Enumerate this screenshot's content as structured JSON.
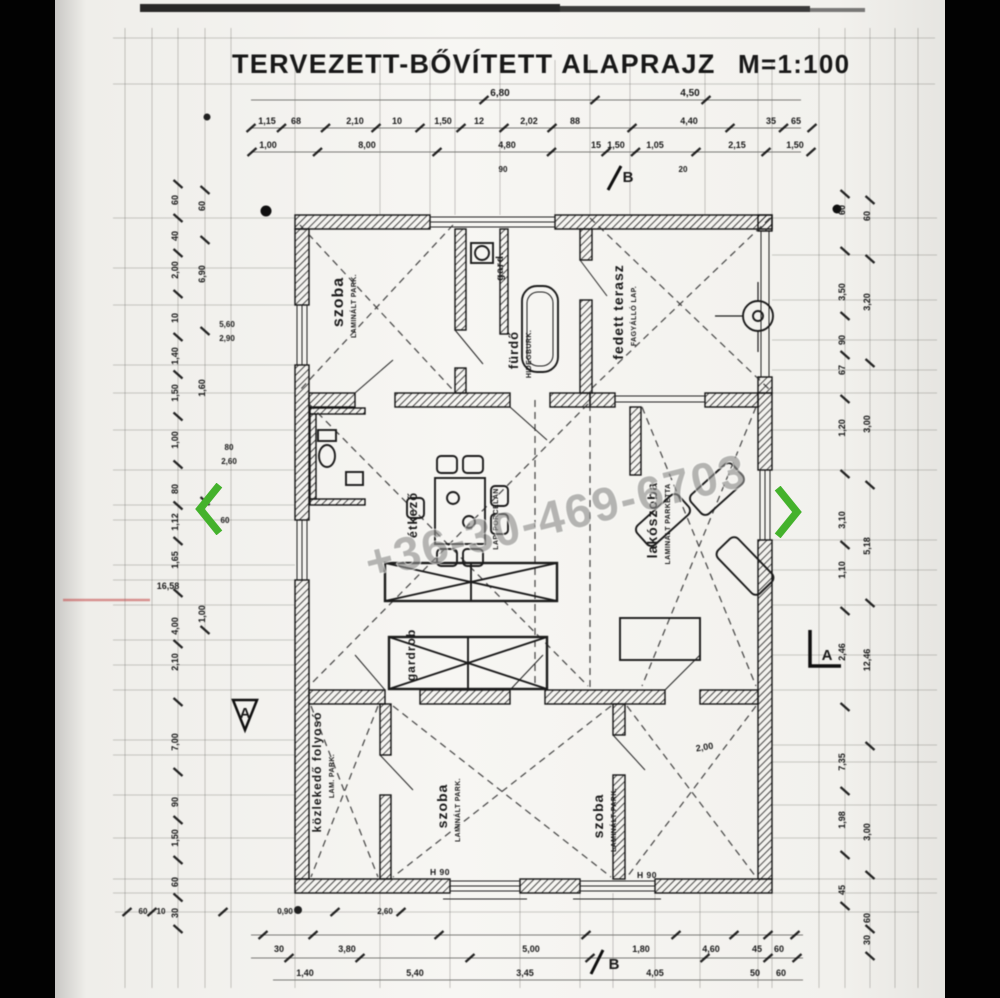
{
  "viewer": {
    "accent_green": "#44b22c",
    "prev_icon": "chevron-left",
    "next_icon": "chevron-right"
  },
  "title": {
    "text": "TERVEZETT-BŐVÍTETT ALAPRAJZ",
    "scale": "M=1:100"
  },
  "watermark": {
    "text": "+36-30-469-6703"
  },
  "rooms": [
    {
      "id": "szoba-top-left",
      "label": "szoba",
      "sub": [
        "LAMINÁLT PARK."
      ],
      "x": 288,
      "y": 302,
      "s": 16
    },
    {
      "id": "gardrob-small",
      "label": "gard.",
      "sub": [],
      "x": 448,
      "y": 266,
      "s": 10
    },
    {
      "id": "furdo",
      "label": "fürdő",
      "sub": [
        "HIDEGBURK."
      ],
      "x": 463,
      "y": 350,
      "s": 13
    },
    {
      "id": "fedett-terasz",
      "label": "fedett terasz",
      "sub": [
        "FAGYÁLLÓ LAP."
      ],
      "x": 568,
      "y": 312,
      "s": 14
    },
    {
      "id": "etkezo",
      "label": "étkező",
      "sub": [
        "LAP. PORCELÁN"
      ],
      "x": 362,
      "y": 515,
      "s": 13,
      "subx": 443
    },
    {
      "id": "lakoszoba",
      "label": "lakószoba",
      "sub": [
        "LAMINÁLT PARKETTA"
      ],
      "x": 602,
      "y": 520,
      "s": 14
    },
    {
      "id": "gardrob",
      "label": "gardrob",
      "sub": [],
      "x": 360,
      "y": 655,
      "s": 12
    },
    {
      "id": "kozlekedo-folyoso",
      "label": "közlekedő folyosó",
      "sub": [
        "LAM. PARK."
      ],
      "x": 266,
      "y": 772,
      "s": 12
    },
    {
      "id": "szoba-bottom-center",
      "label": "szoba",
      "sub": [
        "LAMINÁLT PARK."
      ],
      "x": 392,
      "y": 806,
      "s": 14
    },
    {
      "id": "szoba-bottom-right",
      "label": "szoba",
      "sub": [
        "LAMINÁLT PARK."
      ],
      "x": 548,
      "y": 816,
      "s": 14
    }
  ],
  "dims": {
    "top_rows": [
      {
        "y": 96,
        "s": 10,
        "items": [
          {
            "t": "6,80",
            "x": 445
          },
          {
            "t": "4,50",
            "x": 635
          }
        ]
      },
      {
        "y": 124,
        "s": 9,
        "items": [
          {
            "t": "1,15",
            "x": 212
          },
          {
            "t": "68",
            "x": 241
          },
          {
            "t": "2,10",
            "x": 300
          },
          {
            "t": "10",
            "x": 342
          },
          {
            "t": "1,50",
            "x": 388
          },
          {
            "t": "12",
            "x": 424
          },
          {
            "t": "2,02",
            "x": 474
          },
          {
            "t": "88",
            "x": 520
          },
          {
            "t": "4,40",
            "x": 634
          },
          {
            "t": "35",
            "x": 716
          },
          {
            "t": "65",
            "x": 741
          }
        ]
      },
      {
        "y": 148,
        "s": 9,
        "items": [
          {
            "t": "1,00",
            "x": 213
          },
          {
            "t": "8,00",
            "x": 312
          },
          {
            "t": "4,80",
            "x": 452
          },
          {
            "t": "15",
            "x": 541
          },
          {
            "t": "1,50",
            "x": 561
          },
          {
            "t": "1,05",
            "x": 600
          },
          {
            "t": "2,15",
            "x": 682
          },
          {
            "t": "1,50",
            "x": 740
          }
        ]
      }
    ],
    "bottom_rows": [
      {
        "y": 914,
        "s": 8,
        "items": [
          {
            "t": "60",
            "x": 88
          },
          {
            "t": "10",
            "x": 106
          },
          {
            "t": "0,90",
            "x": 230
          },
          {
            "t": "2,60",
            "x": 330
          }
        ]
      },
      {
        "y": 952,
        "s": 9,
        "items": [
          {
            "t": "30",
            "x": 224
          },
          {
            "t": "3,80",
            "x": 292
          },
          {
            "t": "5,00",
            "x": 476
          },
          {
            "t": "1,80",
            "x": 586
          },
          {
            "t": "4,60",
            "x": 656
          },
          {
            "t": "45",
            "x": 702
          },
          {
            "t": "60",
            "x": 724
          }
        ]
      },
      {
        "y": 976,
        "s": 9,
        "items": [
          {
            "t": "1,40",
            "x": 250
          },
          {
            "t": "5,40",
            "x": 360
          },
          {
            "t": "3,45",
            "x": 470
          },
          {
            "t": "4,05",
            "x": 600
          },
          {
            "t": "50",
            "x": 700
          },
          {
            "t": "60",
            "x": 726
          }
        ]
      }
    ],
    "left_cols": [
      {
        "x": 123,
        "s": 9,
        "items": [
          {
            "t": "60",
            "y": 200
          },
          {
            "t": "40",
            "y": 236
          },
          {
            "t": "2,00",
            "y": 270
          },
          {
            "t": "10",
            "y": 318
          },
          {
            "t": "1,40",
            "y": 356
          },
          {
            "t": "1,50",
            "y": 393
          },
          {
            "t": "1,00",
            "y": 440
          },
          {
            "t": "80",
            "y": 489
          },
          {
            "t": "1,12",
            "y": 522
          },
          {
            "t": "1,65",
            "y": 560
          },
          {
            "t": "4,00",
            "y": 626
          },
          {
            "t": "2,10",
            "y": 662
          },
          {
            "t": "7,00",
            "y": 742
          },
          {
            "t": "90",
            "y": 802
          },
          {
            "t": "1,50",
            "y": 838
          },
          {
            "t": "60",
            "y": 882
          },
          {
            "t": "30",
            "y": 913
          }
        ]
      },
      {
        "x": 150,
        "s": 9,
        "items": [
          {
            "t": "60",
            "y": 206
          },
          {
            "t": "6,90",
            "y": 274
          },
          {
            "t": "1,60",
            "y": 388
          },
          {
            "t": "1,00",
            "y": 614
          }
        ]
      }
    ],
    "right_cols": [
      {
        "x": 790,
        "s": 9,
        "items": [
          {
            "t": "60",
            "y": 210
          },
          {
            "t": "3,50",
            "y": 292
          },
          {
            "t": "90",
            "y": 340
          },
          {
            "t": "67",
            "y": 370
          },
          {
            "t": "1,20",
            "y": 428
          },
          {
            "t": "3,10",
            "y": 520
          },
          {
            "t": "1,10",
            "y": 570
          },
          {
            "t": "2,46",
            "y": 652
          },
          {
            "t": "7,35",
            "y": 762
          },
          {
            "t": "1,98",
            "y": 820
          },
          {
            "t": "45",
            "y": 890
          }
        ]
      },
      {
        "x": 815,
        "s": 9,
        "items": [
          {
            "t": "60",
            "y": 216
          },
          {
            "t": "3,20",
            "y": 302
          },
          {
            "t": "3,00",
            "y": 424
          },
          {
            "t": "5,18",
            "y": 546
          },
          {
            "t": "12,46",
            "y": 660
          },
          {
            "t": "3,00",
            "y": 832
          },
          {
            "t": "60",
            "y": 918
          },
          {
            "t": "30",
            "y": 940
          }
        ]
      }
    ],
    "loose": [
      {
        "t": "16,58",
        "x": 113,
        "y": 589,
        "s": 9
      },
      {
        "t": "5,60",
        "x": 172,
        "y": 327,
        "s": 8
      },
      {
        "t": "2,90",
        "x": 172,
        "y": 341,
        "s": 8
      },
      {
        "t": "80",
        "x": 174,
        "y": 450,
        "s": 8
      },
      {
        "t": "2,60",
        "x": 174,
        "y": 464,
        "s": 8
      },
      {
        "t": "60",
        "x": 170,
        "y": 523,
        "s": 8
      },
      {
        "t": "90",
        "x": 448,
        "y": 172,
        "s": 8
      },
      {
        "t": "20",
        "x": 628,
        "y": 172,
        "s": 8
      },
      {
        "t": "2,00",
        "x": 650,
        "y": 750,
        "s": 9,
        "r": -10
      }
    ]
  },
  "markers": [
    {
      "t": "B",
      "x": 573,
      "y": 182
    },
    {
      "t": "B",
      "x": 559,
      "y": 969
    },
    {
      "t": "A",
      "x": 772,
      "y": 660
    },
    {
      "t": "A",
      "x": 190,
      "y": 718
    }
  ],
  "windows": [
    {
      "t": "H 90",
      "x": 385,
      "y": 875
    },
    {
      "t": "H 90",
      "x": 592,
      "y": 878
    }
  ]
}
